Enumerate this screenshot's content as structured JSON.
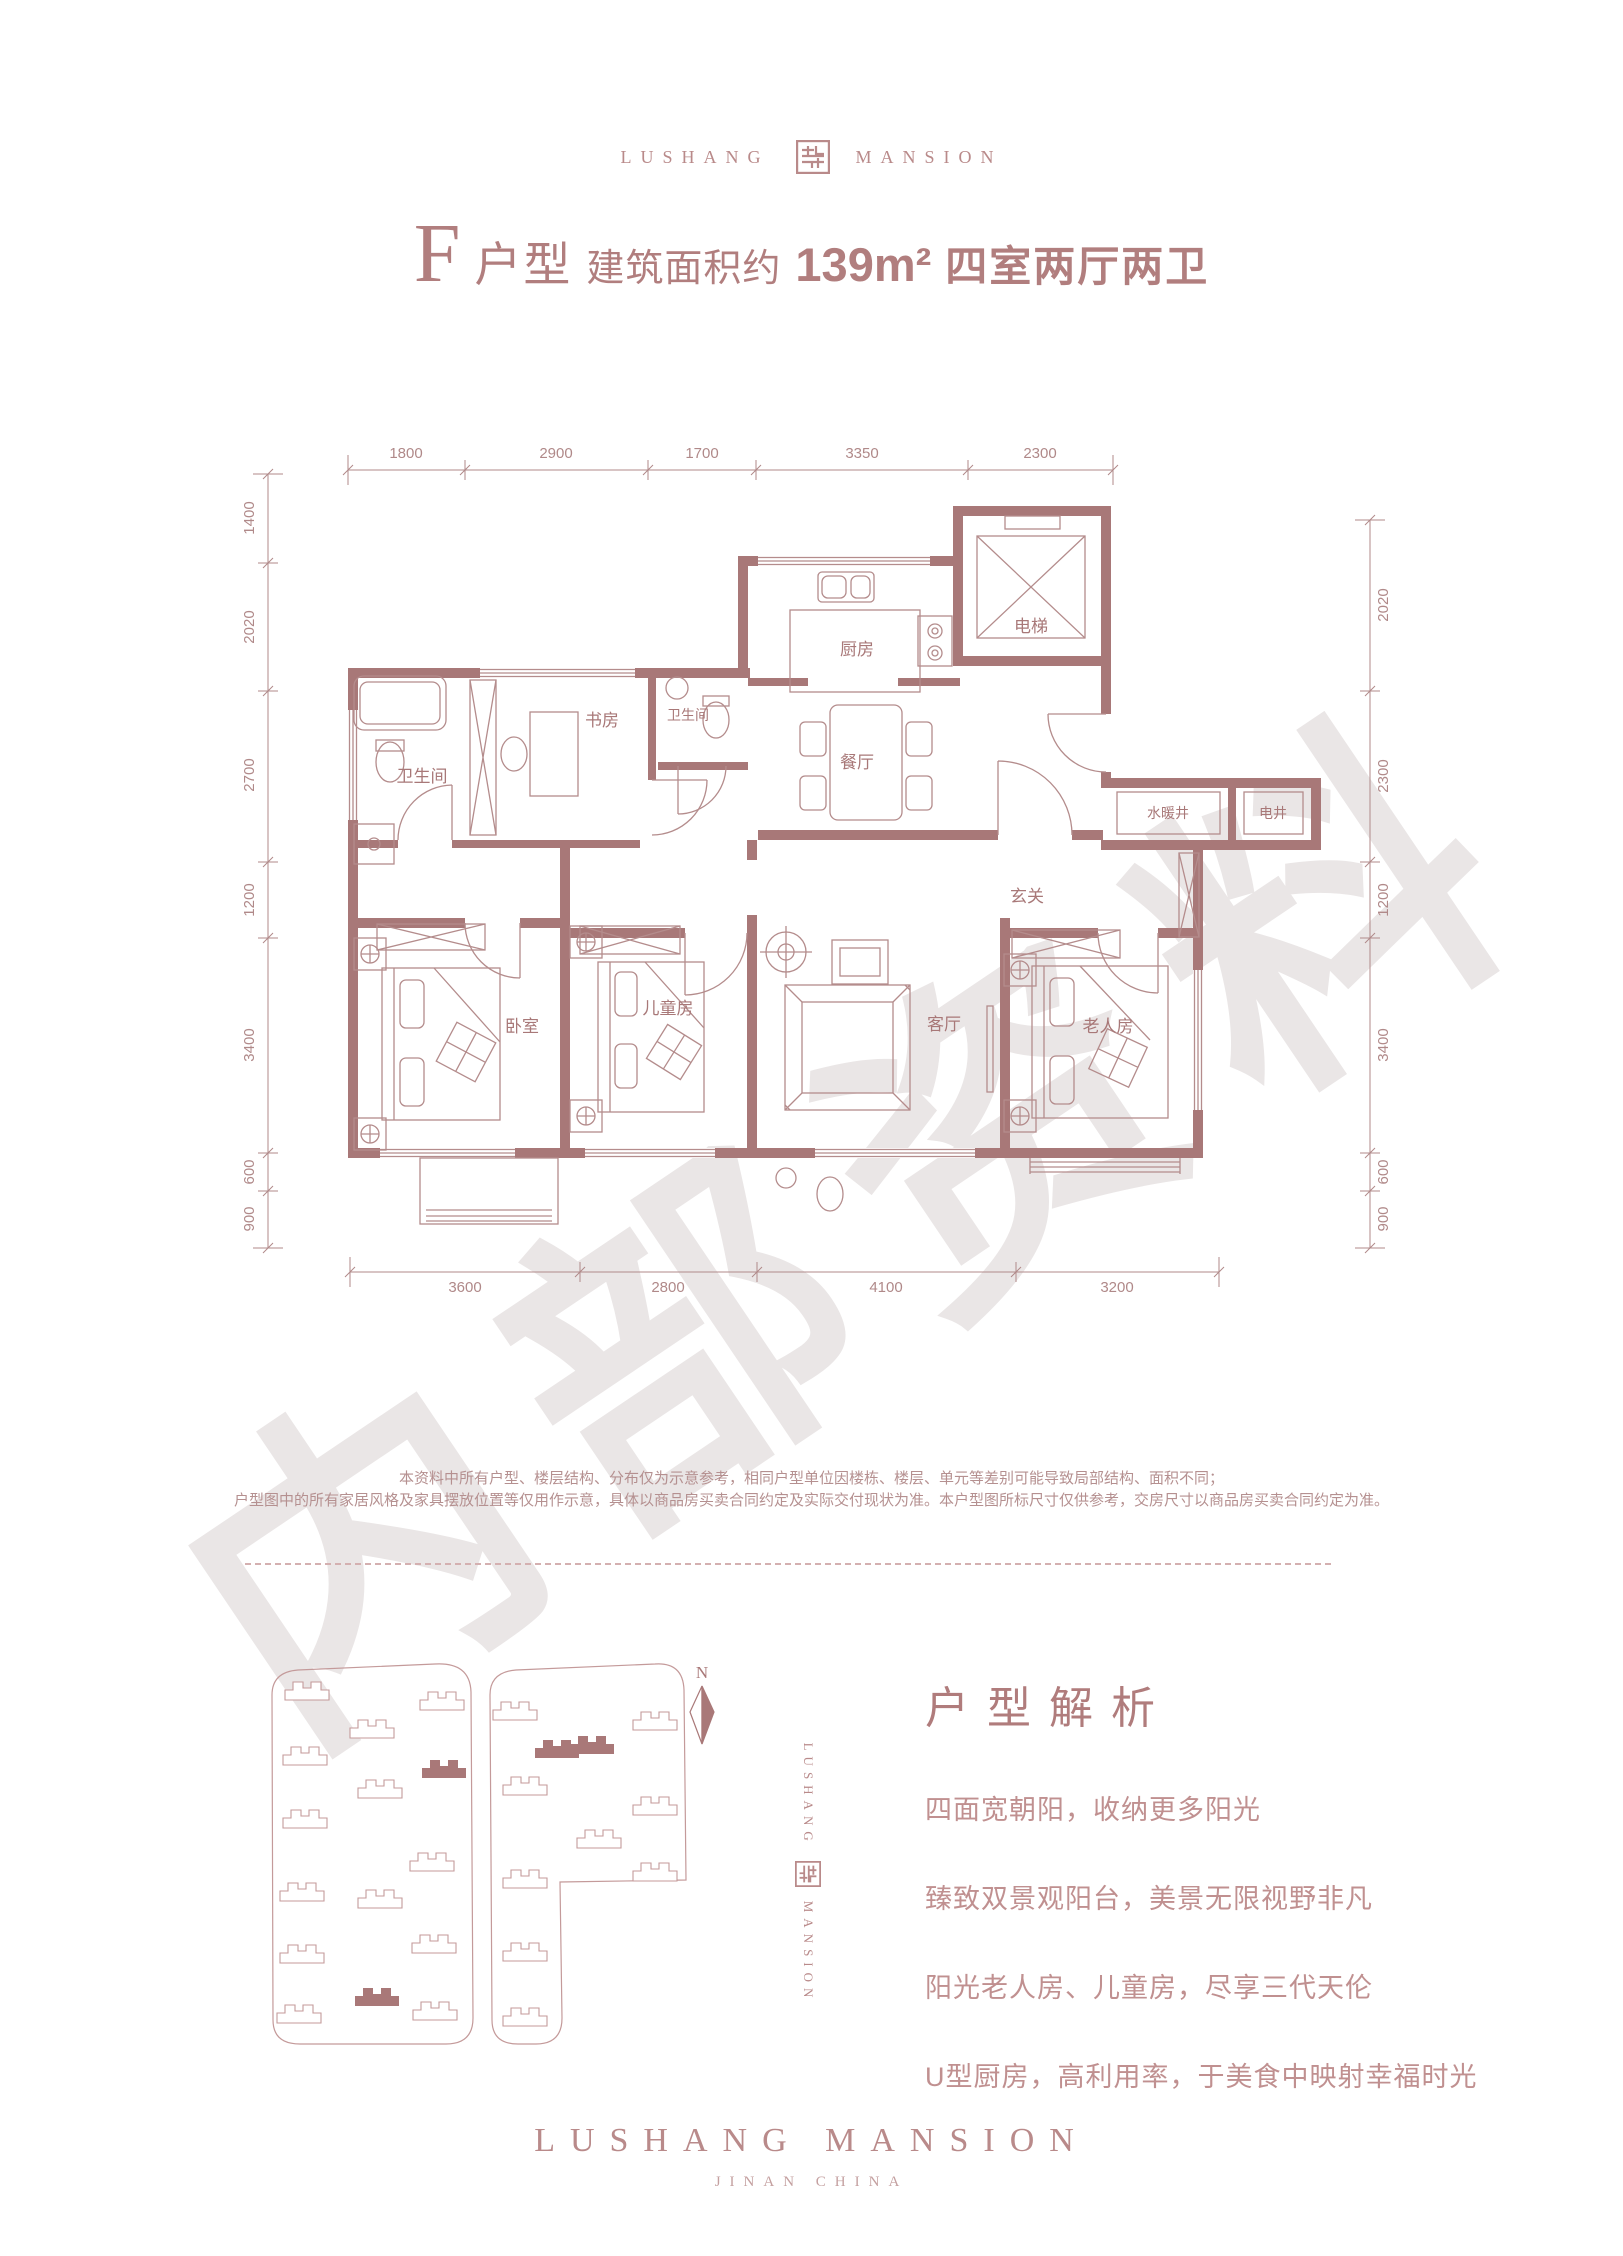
{
  "colors": {
    "brand": "#a97878",
    "wall": "#a87878",
    "thin_line": "#b48c8c",
    "dim_text": "#b08989",
    "watermark": "#eae6e6"
  },
  "header": {
    "logo_left": "LUSHANG",
    "logo_right": "MANSION",
    "seal_icon": "maze-seal"
  },
  "title": {
    "unit": "F",
    "type_label": "户型",
    "area_label": "建筑面积约",
    "area": "139m²",
    "layout": "四室两厅两卫"
  },
  "floorplan": {
    "dims_top": [
      "1800",
      "2900",
      "1700",
      "3350",
      "2300"
    ],
    "dims_left": [
      "1400",
      "2020",
      "2700",
      "1200",
      "3400",
      "600",
      "900"
    ],
    "dims_right": [
      "2020",
      "2300",
      "1200",
      "3400",
      "600",
      "900"
    ],
    "dims_bottom": [
      "3600",
      "2800",
      "4100",
      "3200"
    ],
    "rooms": {
      "kitchen": "厨房",
      "elevator": "电梯",
      "study": "书房",
      "bath_a": "卫生间",
      "bath_b": "卫生间",
      "dining": "餐厅",
      "water_shaft": "水暖井",
      "elec_shaft": "电井",
      "foyer": "玄关",
      "bedroom": "卧室",
      "kids": "儿童房",
      "living": "客厅",
      "elder": "老人房"
    }
  },
  "watermark": "内部资料",
  "disclaimer": {
    "line1": "本资料中所有户型、楼层结构、分布仅为示意参考，相同户型单位因楼栋、楼层、单元等差别可能导致局部结构、面积不同；",
    "line2": "户型图中的所有家居风格及家具摆放位置等仅用作示意，具体以商品房买卖合同约定及实际交付现状为准。本户型图所标尺寸仅供参考，交房尺寸以商品房买卖合同约定为准。"
  },
  "analysis": {
    "heading": "户型解析",
    "points": [
      "四面宽朝阳，收纳更多阳光",
      "臻致双景观阳台，美景无限视野非凡",
      "阳光老人房、儿童房，尽享三代天伦",
      "U型厨房，高利用率，于美食中映射幸福时光"
    ]
  },
  "compass": {
    "label": "N"
  },
  "vertical_logo": {
    "left": "LUSHANG",
    "right": "MANSION"
  },
  "footer": {
    "name": "LUSHANG MANSION",
    "location": "JINAN CHINA"
  }
}
